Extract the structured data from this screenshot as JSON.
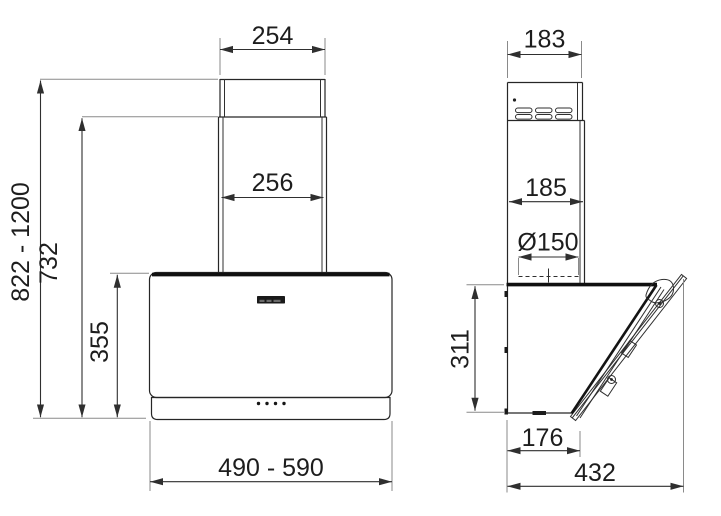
{
  "drawing": {
    "type": "technical-dimension-drawing",
    "subject": "wall-mounted cooker hood, front and side elevation",
    "colors": {
      "background": "#ffffff",
      "line": "#262626",
      "accent_dark": "#101010",
      "extension_line": "#8a8a8a"
    },
    "front_view": {
      "chimney_top_width": "254",
      "chimney_width": "256",
      "height_range": "822 - 1200",
      "chimney_height": "732",
      "body_height": "355",
      "width_range": "490 - 590"
    },
    "side_view": {
      "chimney_top_depth": "183",
      "chimney_depth": "185",
      "duct_diameter": "Ø150",
      "body_height": "311",
      "body_depth": "176",
      "total_depth": "432"
    }
  }
}
